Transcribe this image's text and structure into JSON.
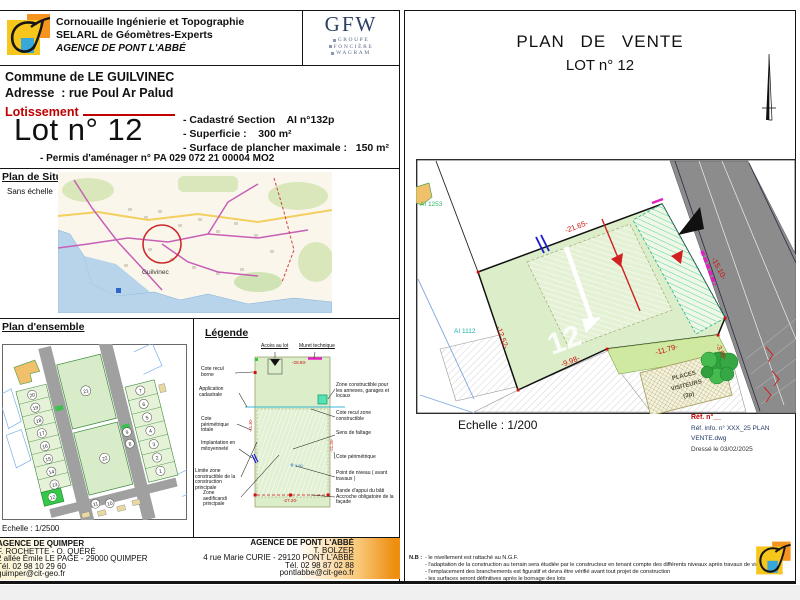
{
  "colors": {
    "red_dim": "#cc1111",
    "red_text": "#c00000",
    "parcel_green": "#dcedc9",
    "teal": "#2fc79c",
    "magenta": "#e020c0",
    "blue_mark": "#1a1acc",
    "road_gray": "#8c8c8c",
    "orange_brand": "#ee8f12",
    "yellow_brand": "#f6c61c"
  },
  "left_page": {
    "header": {
      "line1": "Cornouaille Ingénierie et Topographie",
      "line2": "SELARL de Géomètres-Experts",
      "line3": "AGENCE DE PONT L'ABBÉ"
    },
    "gfw": {
      "acronym": "GFW",
      "words": [
        "GROUPE",
        "FONCIÈRE",
        "WAGRAM"
      ]
    },
    "info": {
      "commune": "Commune de LE GUILVINEC",
      "adresse": "Adresse  : rue Poul Ar Palud",
      "lotissement": "Lotissement",
      "lot_title": "Lot n° 12",
      "cadastre_section": "- Cadastré Section    AI n°132p",
      "superficie": "- Superficie :    300 m²",
      "surface_plancher": "- Surface de plancher maximale :   150 m²",
      "permis": "- Permis d'aménager n° PA 029 072 21 00004 MO2"
    },
    "situation": {
      "title": "Plan de Situation",
      "subtitle": "Sans échelle",
      "place_label": "Guilvinec"
    },
    "ensemble": {
      "title": "Plan d'ensemble",
      "scale": "Echelle : 1/2500",
      "lots_left": [
        "20",
        "19",
        "18",
        "17",
        "16",
        "15",
        "14",
        "13"
      ],
      "lots_right": [
        "7",
        "6",
        "5",
        "4",
        "3",
        "2",
        "1"
      ],
      "lots_mid": [
        "9",
        "8"
      ],
      "lots_bottom": [
        "11",
        "10"
      ],
      "lots_big": [
        "21",
        "22"
      ],
      "highlight_lot": "12"
    },
    "legende": {
      "title": "Légende",
      "labels": {
        "cote_recul_borne": "Cote recul borne",
        "application_cadastrale": "Application cadastrale",
        "cote_perimetrique_totale": "Cote périmétrique totale",
        "implantation_mitoyennete": "Implantation en mitoyenneté",
        "limite_zone_constructible": "Limite zone constructible de la construction principale",
        "zone_aedificandi": "Zone aedificandi principale",
        "acces_au_lot": "Accès au lot",
        "muret_technique": "Muret technique",
        "zone_constructible_annexes": "Zone constructible pour les annexes, garages et locaux",
        "cote_recul_zone": "Cote recul zone constructible",
        "sens_de_faitage": "Sens de faîtage",
        "cote_perimetrique": "Cote périmétrique",
        "point_de_niveau": "Point de niveau ( avant travaux )",
        "bande_appui": "Bande d'appui du bâti Accroche obligatoire de la façade"
      },
      "dims": {
        "top": "-28.80-",
        "bottom": "-27.20-",
        "left": "-41.30-",
        "right": "-21.26-",
        "level": "5.50"
      }
    },
    "footer": {
      "quimper": {
        "l1": "AGENCE DE QUIMPER",
        "l2": "F. ROCHETTE - O. QUÉRÉ",
        "l3": "2 allée Émile LE PAGE - 29000 QUIMPER",
        "l4": "Tél. 02 98 10 29 60",
        "l5": "quimper@cit-geo.fr"
      },
      "pontlabbe": {
        "l1": "AGENCE DE PONT L'ABBÉ",
        "l2": "T. BOLZER",
        "l3": "4 rue Marie CURIE - 29120 PONT L'ABBÉ",
        "l4": "Tél. 02 98 87 02 88",
        "l5": "pontlabbe@cit-geo.fr"
      }
    }
  },
  "right_page": {
    "title_line1": "PLAN DE VENTE",
    "title_line2": "LOT n° 12",
    "plan": {
      "dim_top": "-21.65-",
      "dim_right": "-15.10-",
      "dim_left": "-12.52-",
      "dim_bottom": "-9.98-",
      "dim_small": "-3.09-",
      "dim_strip": "-11.79-",
      "label_nw": "AI 1253",
      "label_w": "AI 1112",
      "watermark": "12",
      "places_l1": "PLACES",
      "places_l2": "VISITEURS",
      "places_l3": "(3p)"
    },
    "scale": "Echelle : 1/200",
    "refs": {
      "ref_no": "Réf. n°__",
      "ref_info": "Réf. info. n° XXX_25 PLAN VENTE.dwg",
      "date": "Dressé le 03/02/2025"
    },
    "nb": {
      "intro": "N.B :",
      "line1": "- le nivellement est rattaché au N.G.F.",
      "line2": "- l'adaptation de la construction au terrain sera étudiée par le constructeur en tenant compte des différents niveaux après travaux de viabilisation",
      "line3": "- l'emplacement des branchements est figuratif et devra être vérifié avant tout projet de construction",
      "line4": "- les surfaces seront définitives après le bornage des lots"
    }
  }
}
